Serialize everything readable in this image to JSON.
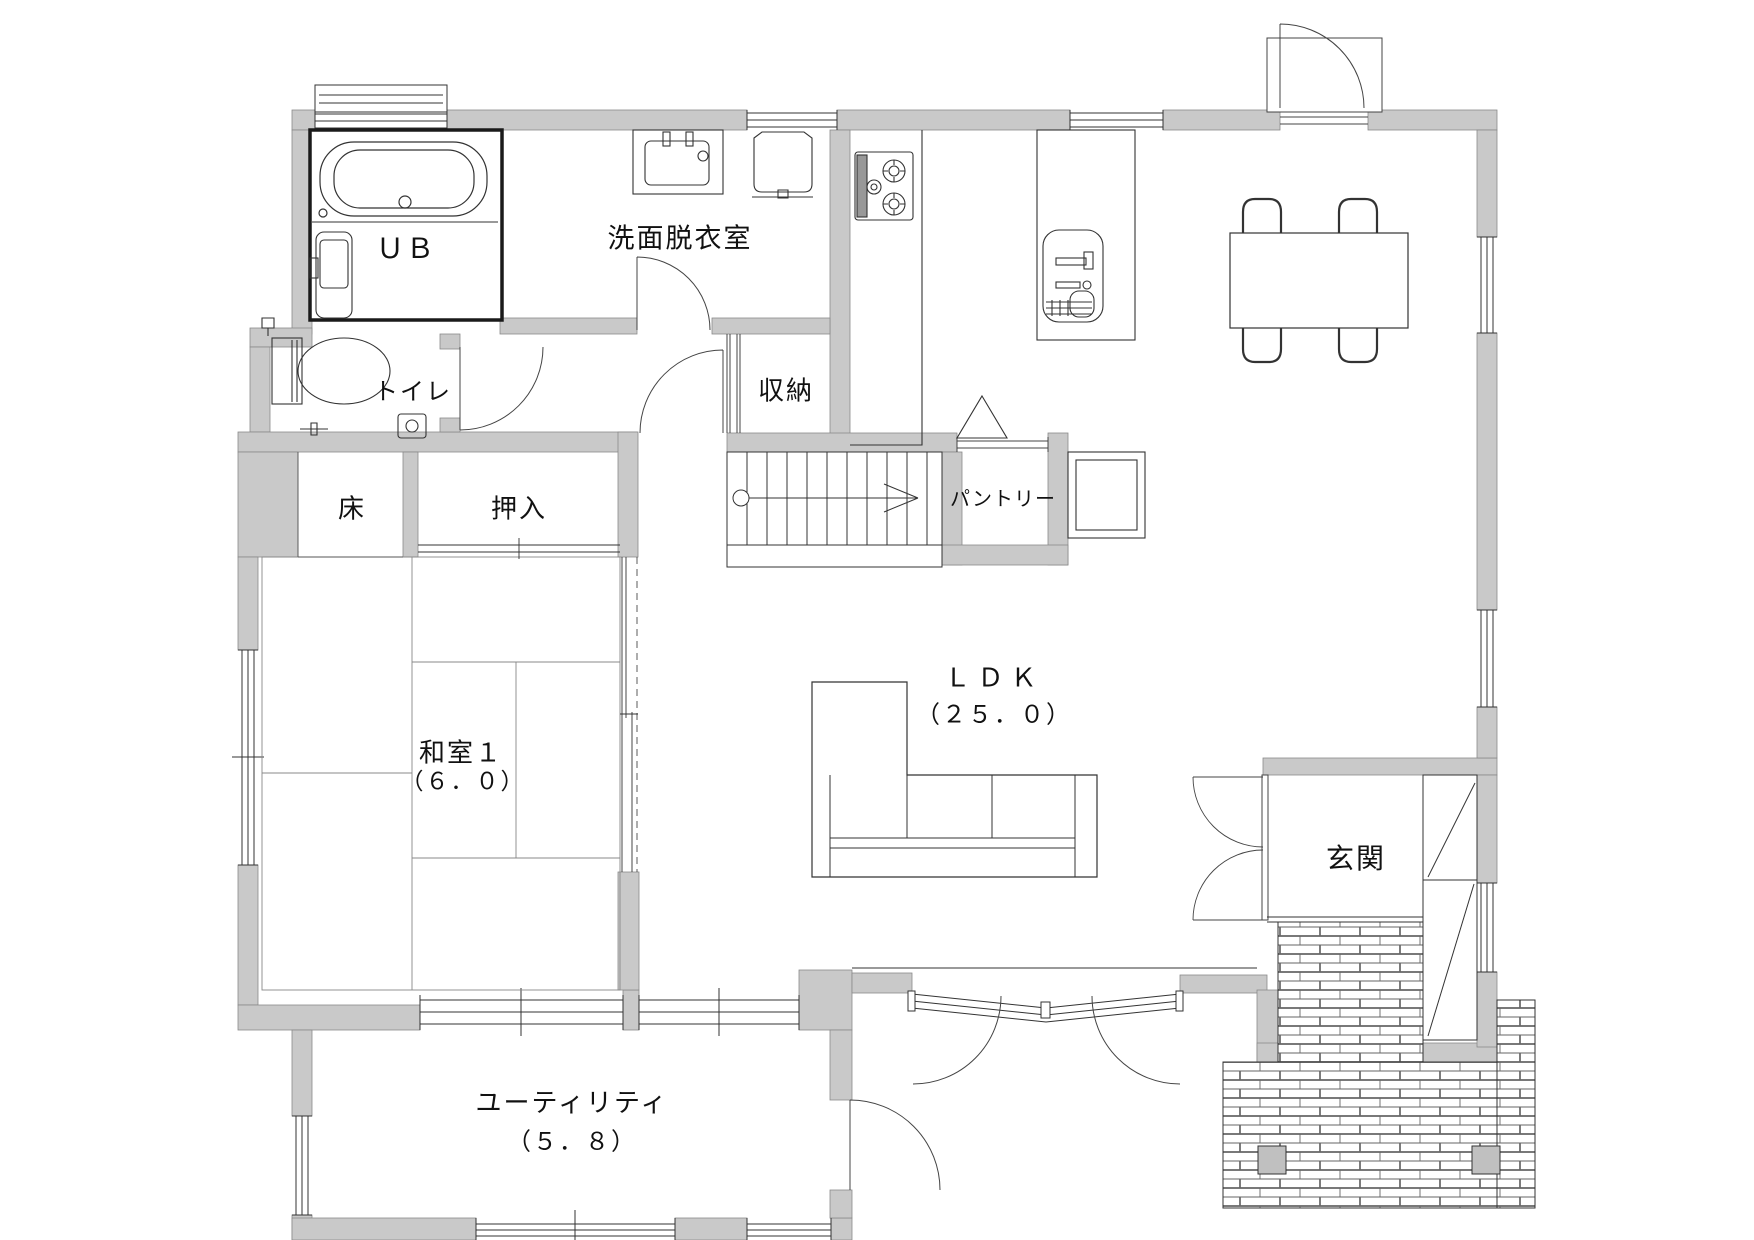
{
  "meta": {
    "drawing_type": "floor-plan",
    "colors": {
      "wall_fill": "#c9c9c9",
      "line": "#333333",
      "unit_bath_border": "#1a1a1a",
      "post_fill": "#c0c0c0"
    }
  },
  "rooms": {
    "unit_bath": {
      "label": "ＵＢ"
    },
    "washroom": {
      "label": "洗面脱衣室"
    },
    "toilet": {
      "label": "トイレ"
    },
    "storage": {
      "label": "収納"
    },
    "pantry": {
      "label": "パントリー"
    },
    "tokonoma": {
      "label": "床"
    },
    "closet": {
      "label": "押入"
    },
    "japanese_room": {
      "label": "和室１",
      "area": "（６．０）"
    },
    "ldk": {
      "label": "ＬＤＫ",
      "area": "（２５．０）"
    },
    "entrance": {
      "label": "玄関"
    },
    "utility": {
      "label": "ユーティリティ",
      "area": "（５．８）"
    }
  }
}
